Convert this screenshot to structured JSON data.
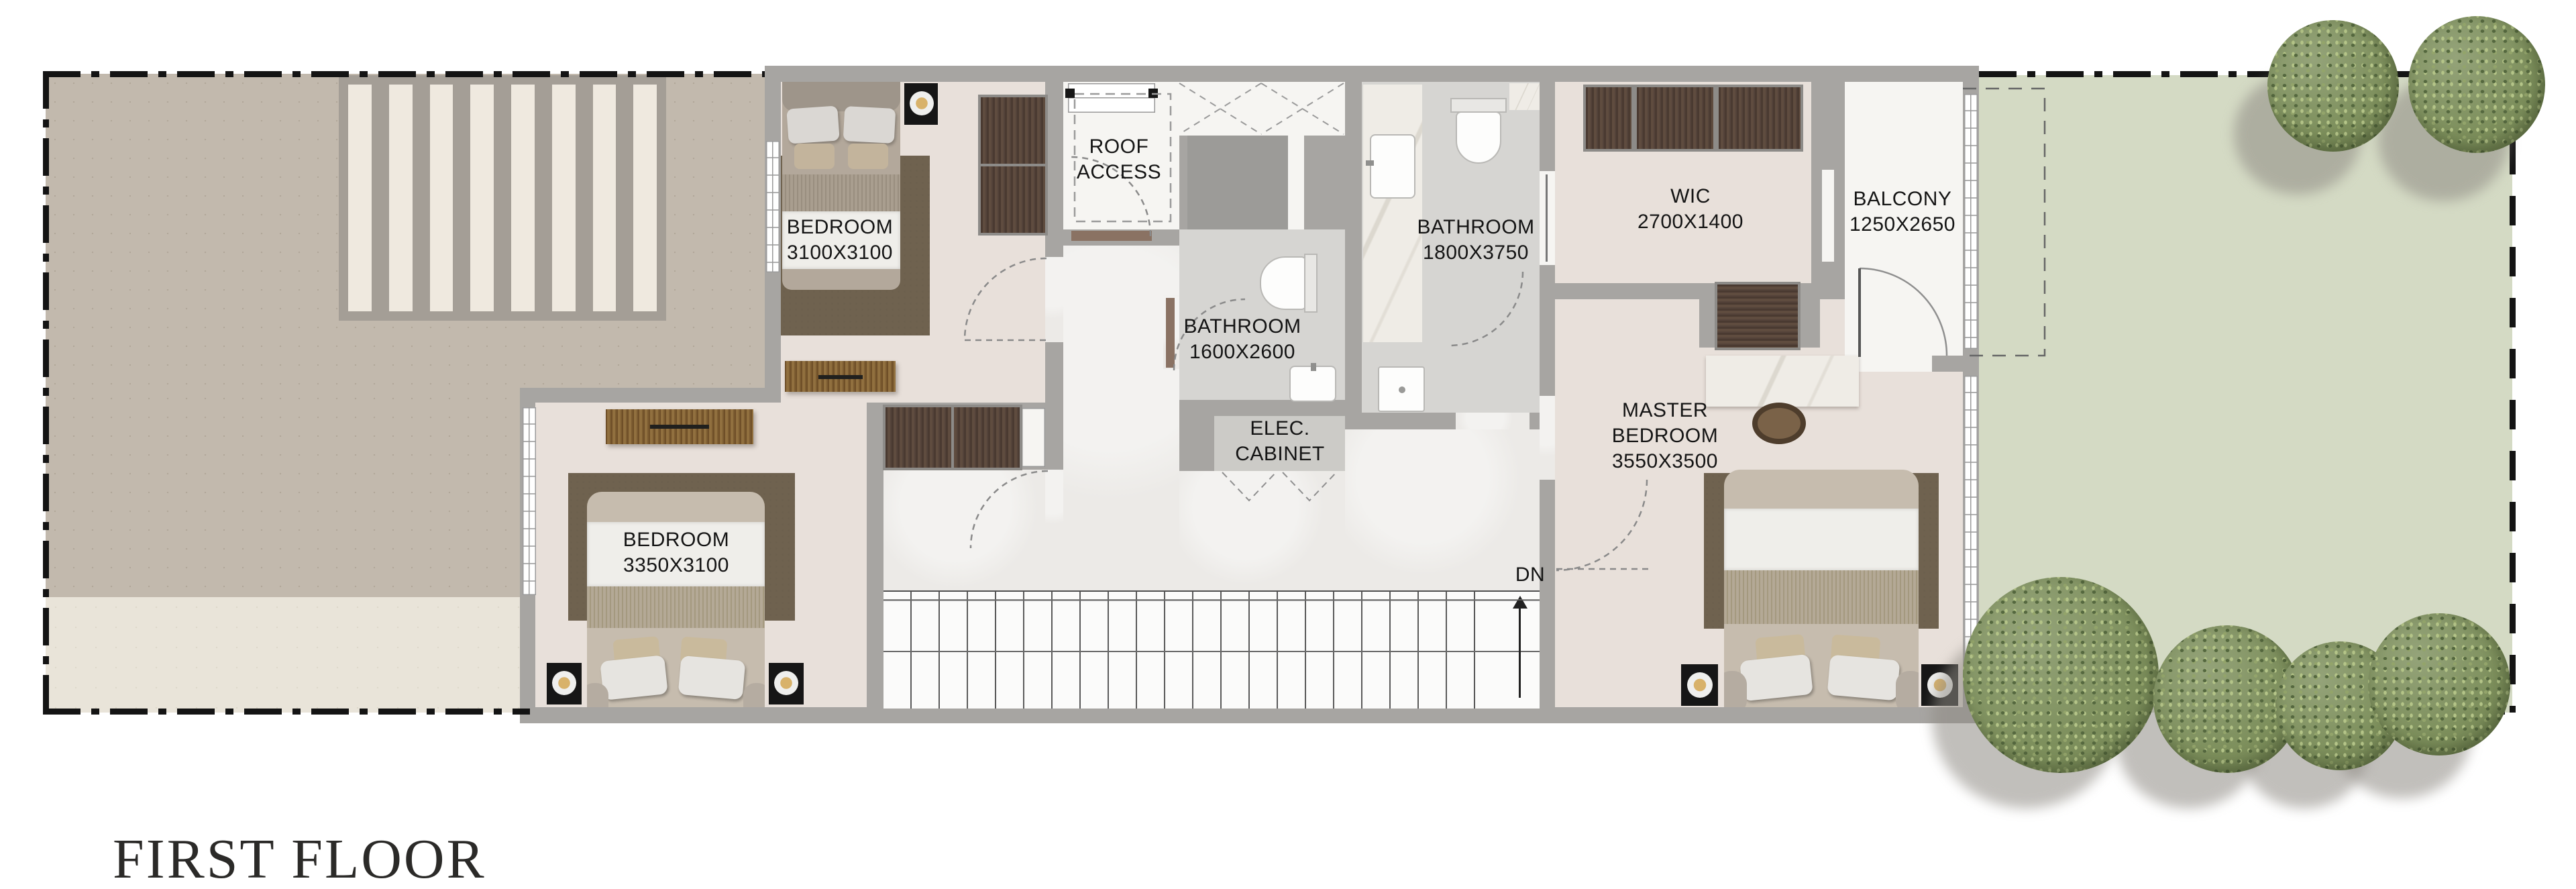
{
  "title": "FIRST FLOOR",
  "rooms": {
    "bedroom1": {
      "name": "BEDROOM",
      "dims": "3100X3100"
    },
    "bedroom2": {
      "name": "BEDROOM",
      "dims": "3350X3100"
    },
    "master_bedroom": {
      "line1": "MASTER",
      "line2": "BEDROOM",
      "dims": "3550X3500"
    },
    "wic": {
      "name": "WIC",
      "dims": "2700X1400"
    },
    "balcony": {
      "name": "BALCONY",
      "dims": "1250X2650"
    },
    "bathroom_small": {
      "name": "BATHROOM",
      "dims": "1600X2600"
    },
    "bathroom_master": {
      "name": "BATHROOM",
      "dims": "1800X3750"
    },
    "roof_access": {
      "line1": "ROOF",
      "line2": "ACCESS"
    },
    "elec_cabinet": {
      "line1": "ELEC.",
      "line2": "CABINET"
    }
  },
  "stairs": {
    "label": "DN"
  },
  "colors": {
    "boundary": "#141414",
    "wall": "#a7a5a2",
    "room_floor": "#e8e0da",
    "corridor_marble": "#eceae7",
    "bathroom_floor": "#d6d5d2",
    "terrace": "#c2b9ad",
    "terrace_light": "#e9e4d9",
    "lawn": "#d4dac4",
    "tree_foliage": "#7d8f5c",
    "dark_wood": "#52413a",
    "medium_wood": "#8a6a3e",
    "marble_counter": "#efece6",
    "rug": "#6f624f"
  }
}
